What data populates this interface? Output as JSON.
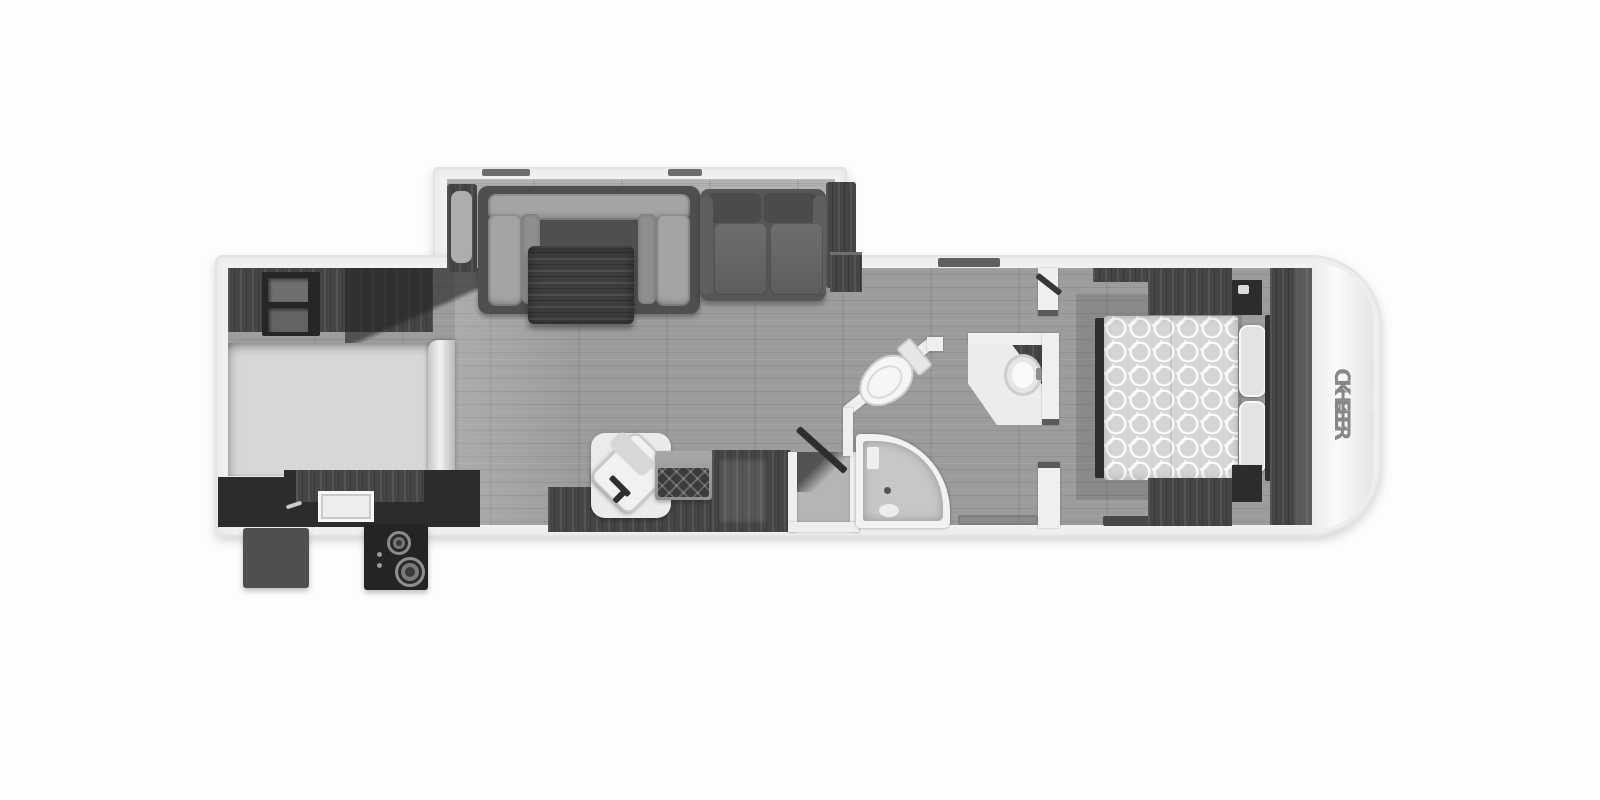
{
  "brand": {
    "logo_prefix": "CHER",
    "logo_suffix": "KEE",
    "logo_full": "CHEROKEE",
    "logo_color": "#878787"
  },
  "palette": {
    "page_background": "#fdfdfd",
    "wall_white": "#f1f1f1",
    "floor_wood_gray": "#9c9c9c",
    "slide_floor": "#b2b2b2",
    "bunk_platform": "#d7d7d7",
    "dark_wood_cabinet": "#454545",
    "appliance_black": "#2c2c2c",
    "fixture_white": "#f5f5f5",
    "quilt_gray": "#d5d5d5"
  },
  "floorplan": {
    "type": "travel-trailer top-view floor plan",
    "front_cap": "rounded white cap with vertical Cherokee logo (right end)",
    "areas": [
      "rear bunk and kitchen area with outside griddle",
      "living area slide-out with U-dinette and sofa",
      "living area with recliner, fireplace and entertainment center",
      "split bathroom with toilet, corner shower and sink vanity",
      "front bedroom with queen bed, wardrobes and nightstands"
    ],
    "fixtures": [
      "pantry-shelves",
      "bunk-platform",
      "kitchen-counter",
      "kitchen-sink",
      "refrigerator",
      "outside-griddle",
      "outside-storage-box",
      "u-dinette",
      "dinette-table",
      "sofa",
      "recliner",
      "fireplace",
      "entertainment-center",
      "entry-door",
      "toilet",
      "corner-shower",
      "sink-vanity",
      "queen-bed",
      "pillows",
      "nightstands",
      "wardrobes",
      "front-closet",
      "windows",
      "sliding-door-threshold"
    ]
  }
}
